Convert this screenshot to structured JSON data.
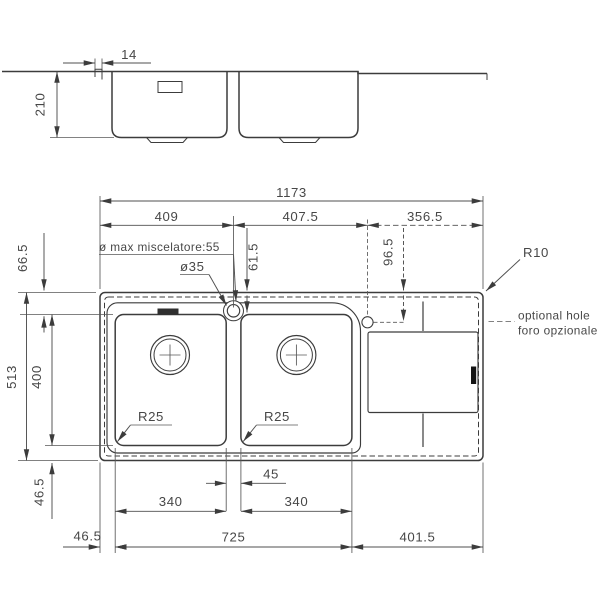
{
  "meta": {
    "description": "Technical dimension drawing of a double-bowl kitchen sink with right drainboard, front elevation and plan view",
    "colors": {
      "line": "#3c3c3c",
      "text": "#474747",
      "background": "#ffffff"
    }
  },
  "elevation": {
    "dim_rim_lip": "14",
    "dim_depth": "210"
  },
  "plan": {
    "dim_overall_width": "1173",
    "dim_section_left": "409",
    "dim_section_center": "407.5",
    "dim_section_right": "356.5",
    "dim_top_edge_to_bowl": "66.5",
    "dim_faucet_center_offset": "61.5",
    "dim_optional_hole_offset": "96.5",
    "radius_corner": "R10",
    "dim_overall_depth": "513",
    "dim_bowl_depth": "400",
    "radius_bowl_left": "R25",
    "radius_bowl_right": "R25",
    "dim_bowl_to_bottom_edge": "46.5",
    "dim_left_edge_to_bowl": "46.5",
    "dim_bowl_gap": "45",
    "dim_bowl_left_width": "340",
    "dim_bowl_right_width": "340",
    "dim_bowls_overall": "725",
    "dim_drainboard": "401.5",
    "note_faucet_max": "ø max miscelatore:55",
    "note_faucet_hole": "ø35",
    "note_optional_hole_en": "optional hole",
    "note_optional_hole_it": "foro opzionale"
  }
}
